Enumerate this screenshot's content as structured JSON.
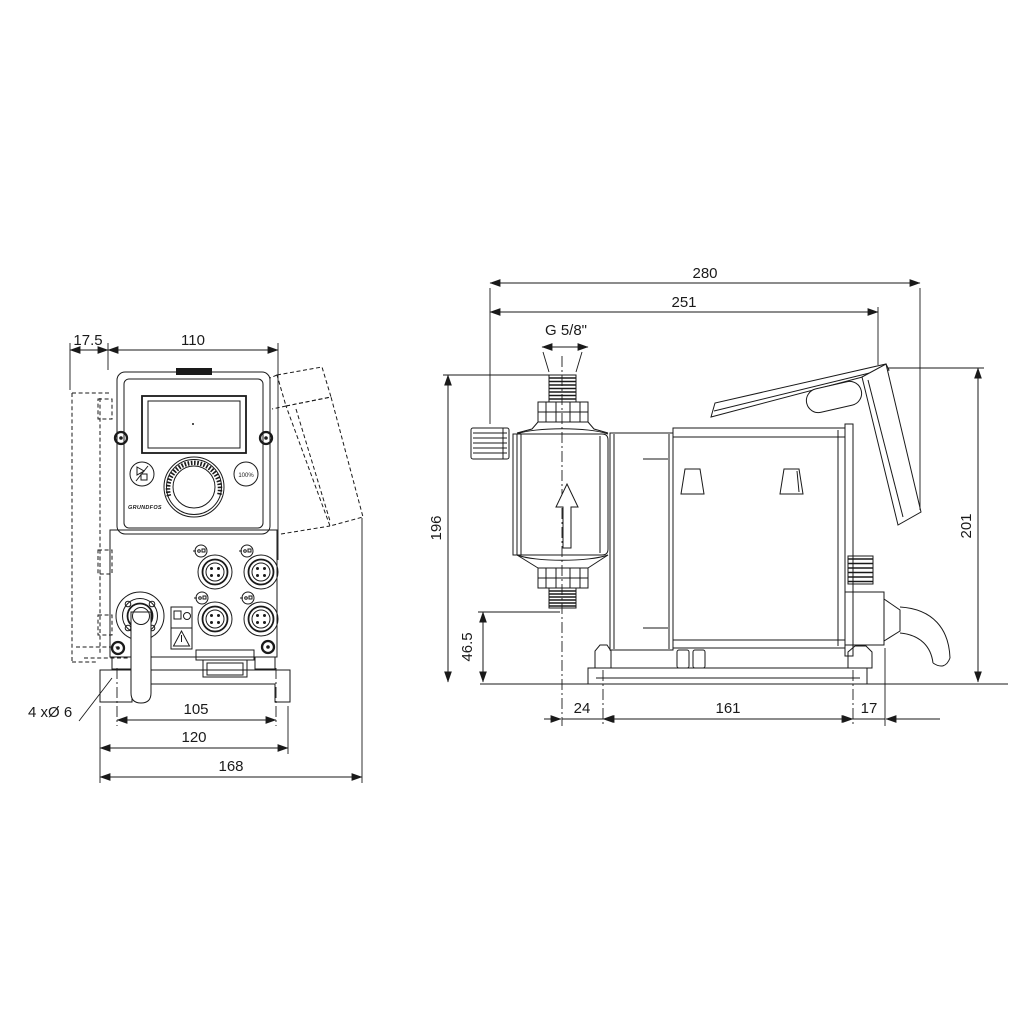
{
  "front_view": {
    "dim_offset": "17.5",
    "dim_width": "110",
    "dim_hole_note": "4 xØ 6",
    "dim_hole_spacing": "105",
    "dim_plate_width": "120",
    "dim_overall_width": "168",
    "control_panel": {
      "button_100": "100%",
      "logo": "GRUNDFOS"
    }
  },
  "side_view": {
    "dim_overall_depth": "280",
    "dim_depth_to_cover": "251",
    "dim_thread": "G 5/8\"",
    "dim_height": "196",
    "dim_suction_height": "46.5",
    "dim_total_height": "201",
    "dim_front_overhang": "24",
    "dim_base_length": "161",
    "dim_rear_overhang": "17"
  },
  "colors": {
    "line": "#1a1a1a",
    "background": "#ffffff"
  }
}
